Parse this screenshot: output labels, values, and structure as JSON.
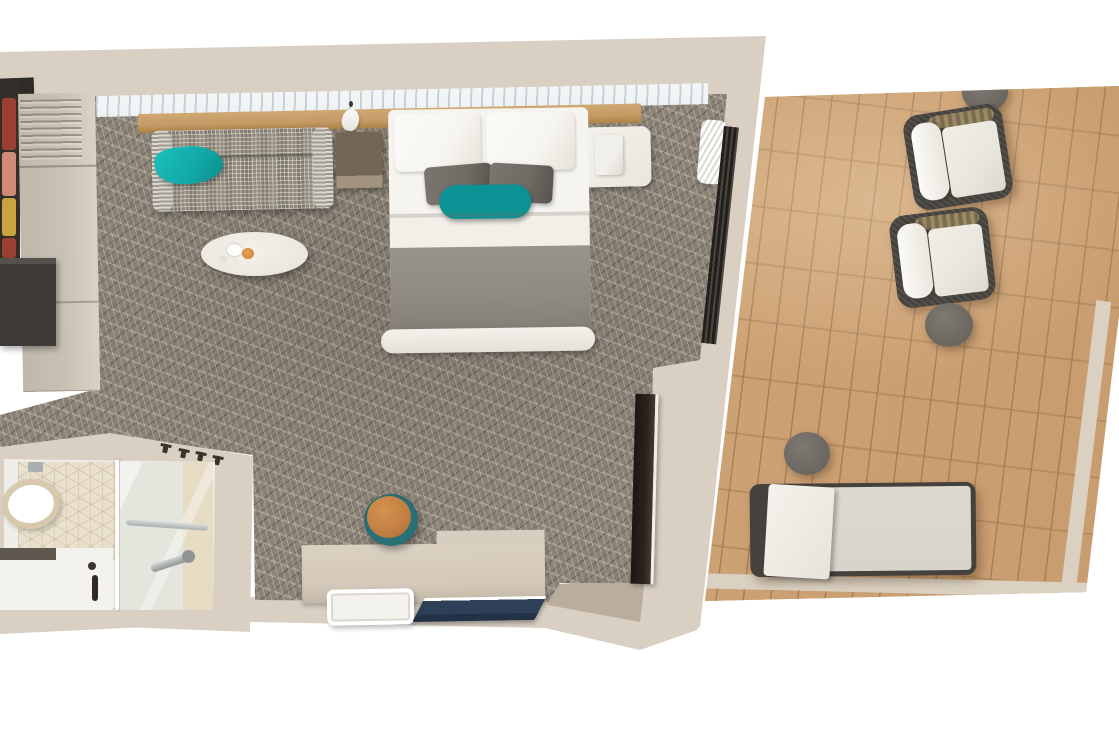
{
  "scene": {
    "kind": "top-down 3D floor plan render",
    "subject": "stateroom with en-suite bathroom and private balcony",
    "visible_text": "none",
    "areas": {
      "stateroom": {
        "furniture": [
          "wardrobe",
          "open-closet-with-clothes",
          "dark-cabinet",
          "sofa",
          "teal-throw-blanket",
          "side-table",
          "oval-coffee-table",
          "double-bed",
          "white-pillows",
          "gray-pillows",
          "teal-accent-pillow",
          "gray-blanket",
          "foot-bench",
          "white-nightstand",
          "pendant-light",
          "window-with-curtain",
          "headboard-shelf",
          "full-length-mirror",
          "balcony-door-track",
          "curtain-bundle",
          "desk",
          "stool",
          "tray",
          "navy-folder"
        ]
      },
      "bathroom": {
        "furniture": [
          "toilet",
          "flush-plate",
          "vanity-sink",
          "faucet",
          "glass-shower",
          "towel-bar",
          "hand-shower",
          "tile-wall",
          "wall-hooks"
        ]
      },
      "balcony": {
        "furniture": [
          "wicker-armchair-1",
          "wicker-armchair-2",
          "round-side-table-top",
          "round-side-table-middle",
          "round-side-table-low",
          "sun-lounger",
          "wood-deck"
        ]
      }
    }
  },
  "colors": {
    "pageBg": "#ffffff",
    "wall": "#d9cfc2",
    "bandTaupe": "#b9ae9e",
    "carpet": "#8c8377",
    "deck": "#d1a87c",
    "deckTrim": "#dbd1c2",
    "deckTable": "#6b6660",
    "chairFrame": "#45413c",
    "chairCushion": "#e9e6dd",
    "loungerCushion": "#d7d4cc",
    "windowGlass": "#eef2f2",
    "woodShelf": "#c49a66",
    "wardrobe": "#c8c1b4",
    "closetDark": "#322e2a",
    "charcoal": "#3d3a37",
    "sofa": "#8f887b",
    "sofaArm": "#b5afa3",
    "teal": "#12aaa8",
    "tealPillow": "#0c9195",
    "tableWhite": "#ece7de",
    "candle": "#c57b2e",
    "bedWhite": "#f2efe9",
    "pillowWhite": "#f7f5f0",
    "pillowGray": "#6e6a64",
    "blanket": "#8f8a83",
    "trackDark": "#221f1c",
    "mirrorDark": "#2a221c",
    "tile": "#e9e1ce",
    "toiletSeat": "#d6c9ad",
    "vanityWhite": "#f4f2ec",
    "glass": "#e4e6dd",
    "chrome": "#aab0ae",
    "desk": "#d3c8b9",
    "navy": "#2d4057",
    "stoolTop": "#c07c40",
    "stoolBase": "#2a7077",
    "clothes1": "#9c4034",
    "clothes2": "#cf8a78",
    "clothes3": "#c9a43c"
  }
}
